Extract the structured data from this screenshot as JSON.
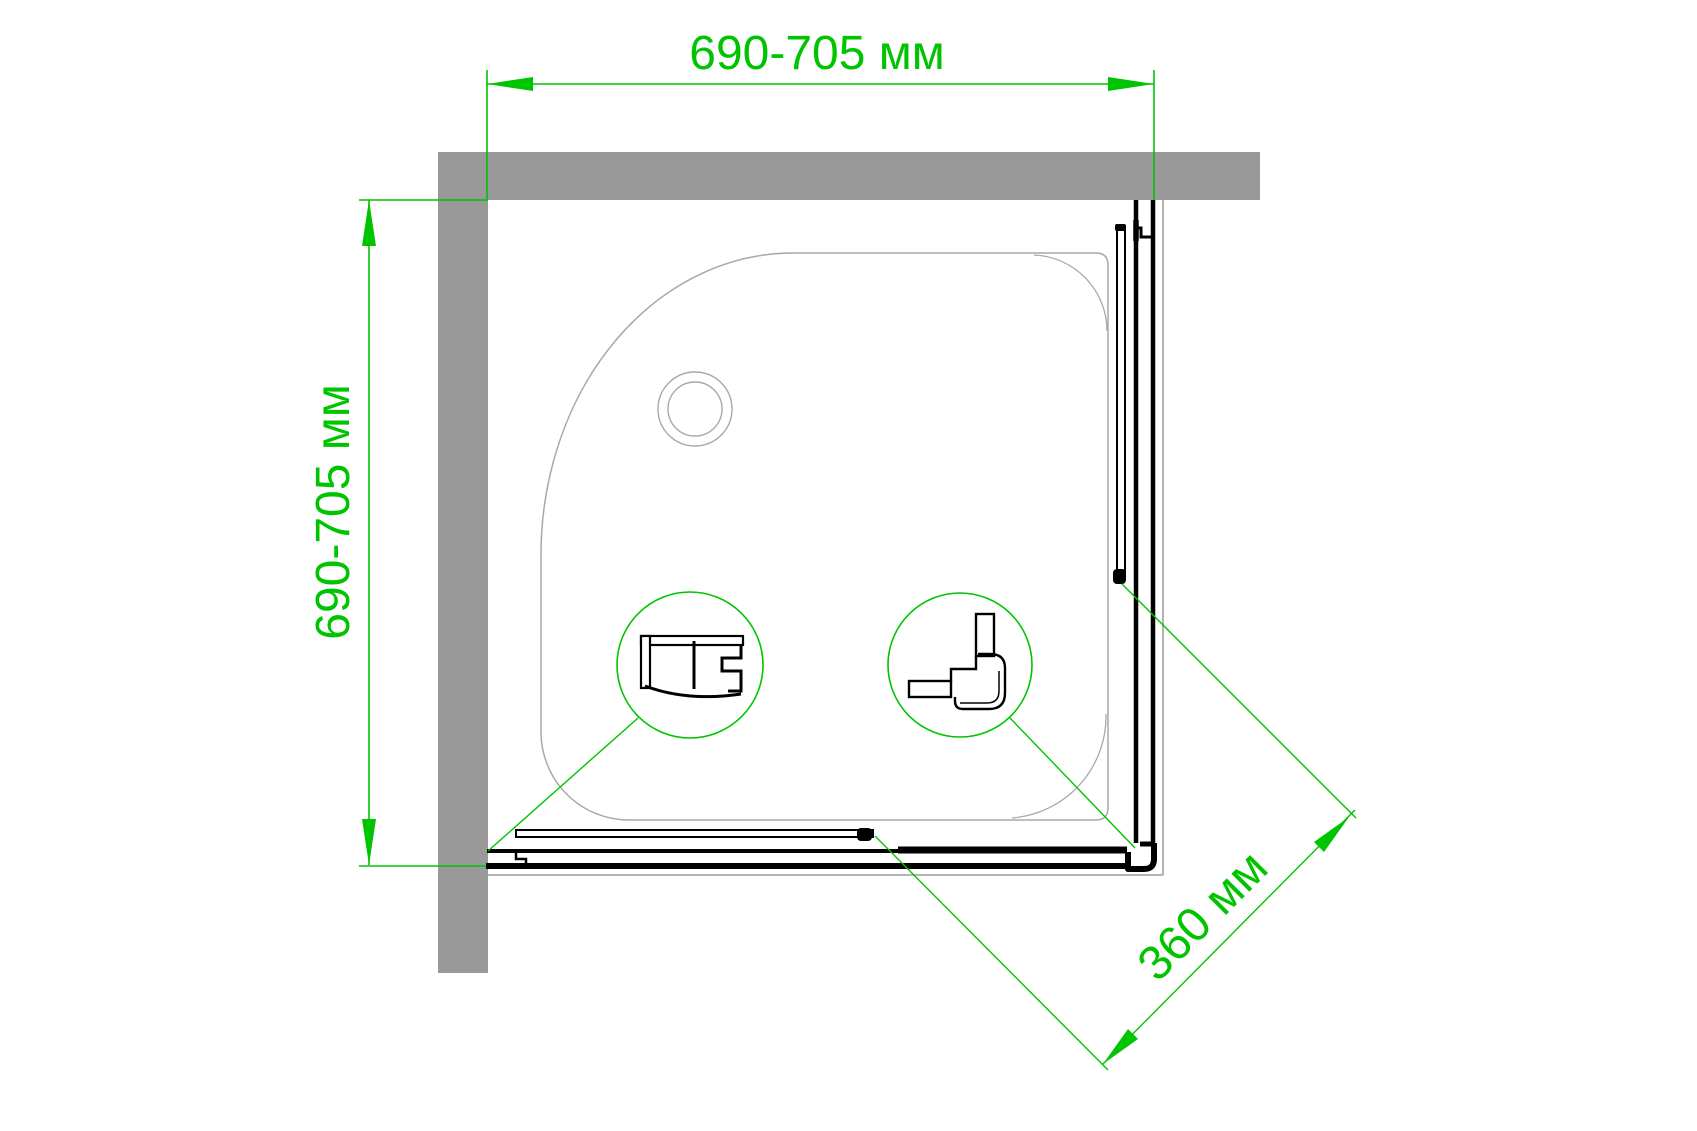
{
  "diagram": {
    "kind": "shower-enclosure-plan-drawing",
    "labels": {
      "width": "690-705 мм",
      "height": "690-705 мм",
      "entry_diagonal": "360 мм"
    },
    "colors": {
      "dimension": "#00c400",
      "wall": "#999999",
      "tray_outline": "#a9a9a9",
      "profile": "#000000",
      "background": "#ffffff"
    }
  }
}
